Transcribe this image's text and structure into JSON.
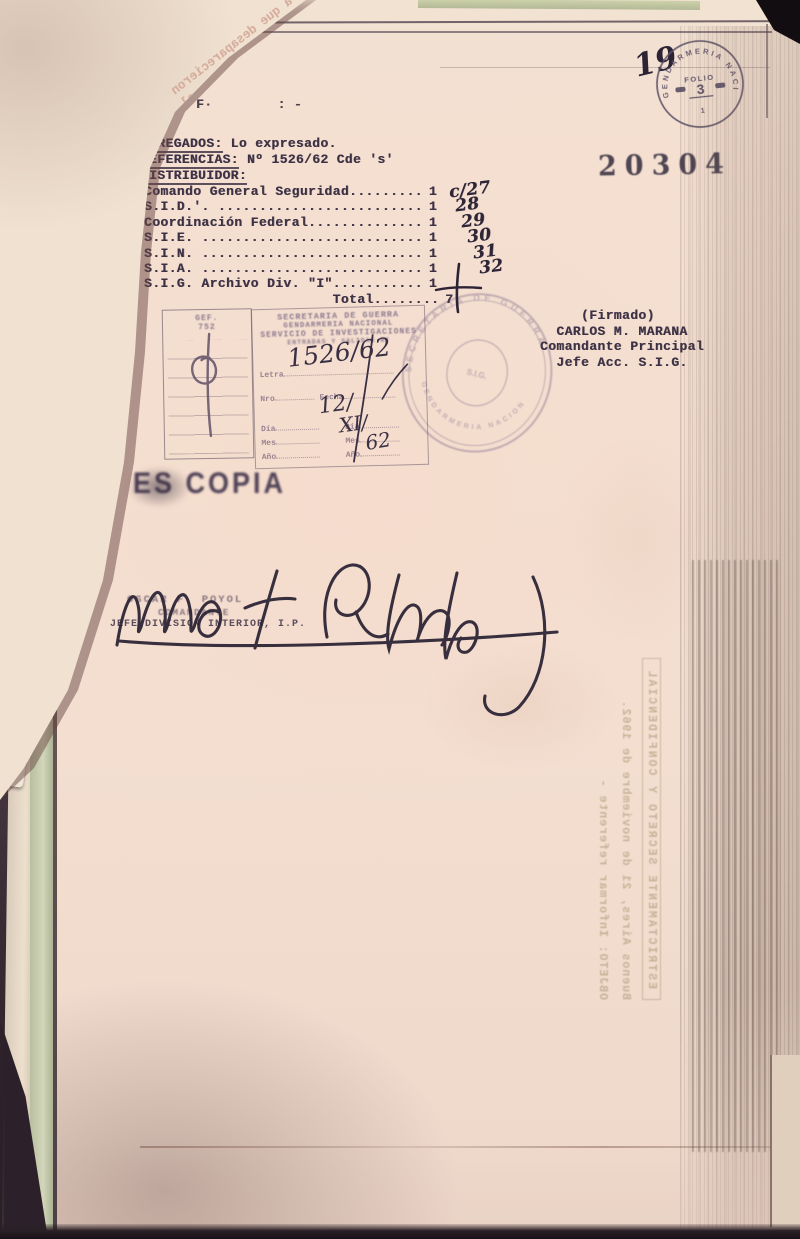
{
  "document": {
    "page_number_handwritten": "19",
    "registry_stamp_number": "20304",
    "top_fragment": "F·        : -",
    "folio_stamp": {
      "ring_text": "GENDARMERIA NACIONAL",
      "label": "FOLIO",
      "number": "3",
      "footer": "1"
    },
    "agregados": {
      "label": "AGREGADOS:",
      "value": " Lo expresado."
    },
    "referencias": {
      "label": "REFERENCIAS:",
      "value": " Nº 1526/62 Cde 's'"
    },
    "distribuidor_label": "DISTRIBUIDOR:",
    "distribution_rows": [
      {
        "name": "Comando General Seguridad.",
        "dots": "........",
        "copies": "1",
        "note": "c/27"
      },
      {
        "name": "S.I.D.'. ",
        "dots": ".........................",
        "copies": "1",
        "note": "28"
      },
      {
        "name": "Coordinación Federal",
        "dots": "..............",
        "copies": "1",
        "note": "29"
      },
      {
        "name": "S.I.E. ",
        "dots": "...........................",
        "copies": "1",
        "note": "30"
      },
      {
        "name": "S.I.N. ",
        "dots": "...........................",
        "copies": "1",
        "note": "31"
      },
      {
        "name": "S.I.A. ",
        "dots": "...........................",
        "copies": "1",
        "note": "32"
      },
      {
        "name": "S.I.G. Archivo Div. \"I\"",
        "dots": "...........",
        "copies": "1",
        "note": ""
      },
      {
        "name": "                       Total",
        "dots": "........",
        "copies": "7",
        "note": ""
      }
    ],
    "signature_block": {
      "firmado": "     (Firmado)",
      "name": "  CARLOS M. MARANA",
      "rank": "Comandante Principal",
      "title": "  Jefe Acc. S.I.G."
    },
    "es_copia_stamp": "ES COPIA",
    "signer_stamp": {
      "name": "OSCAR F. POYOL",
      "rank": "COMANDANTE",
      "title": "JEFE DIVISION INTERIOR, I.P."
    }
  },
  "registry_box": {
    "header1": "SECRETARIA DE GUERRA",
    "header2": "GENDARMERIA NACIONAL",
    "header3": "SERVICIO DE INVESTIGACIONES",
    "header4": "ENTRADAS Y SALIDAS Nº",
    "field_letra": "Letra",
    "field_nro": "Nro",
    "field_fecha": "Fecha",
    "field_dia": "Día",
    "field_mes": "Mes",
    "field_ano": "Año",
    "handwritten_number": "1526/62",
    "handwritten_day": "12/",
    "handwritten_month": "XI/",
    "handwritten_year": "62",
    "side_box_line1": "GEF.",
    "side_box_line2": "752"
  },
  "round_seal": {
    "text_top": "SECRETARIA DE GUERRA",
    "text_bottom": "GENDARMERIA NACIONAL",
    "center": "S.I.G."
  },
  "ghost_text": {
    "heading": "ESTRICTAMENTE SECRETO Y CONFIDENCIAL",
    "date_line": "Buenos Aires, 21 de noviembre de 1962.",
    "body_line": "OBJETO: Informar referente -"
  },
  "folded_page_fragments": [
    "a que desaparecieron",
    "tes de invitarlos al",
    "do recibidos en el",
    "se entrevista en los",
    "ula navegando en",
    "por atender y el aviso",
    "las notas de que el",
    "hora de que llegara",
    "an a el edificio de la",
    "Por el llamado BAUDI",
    "mientras SALAS , había",
    "tamentos en que se"
  ],
  "colors": {
    "paper": "#f3ded0",
    "ink": "#3c3144",
    "stamp_faded": "#8d7990",
    "hand_ink": "#2e2637",
    "folder_green": "#ccd1b4"
  }
}
